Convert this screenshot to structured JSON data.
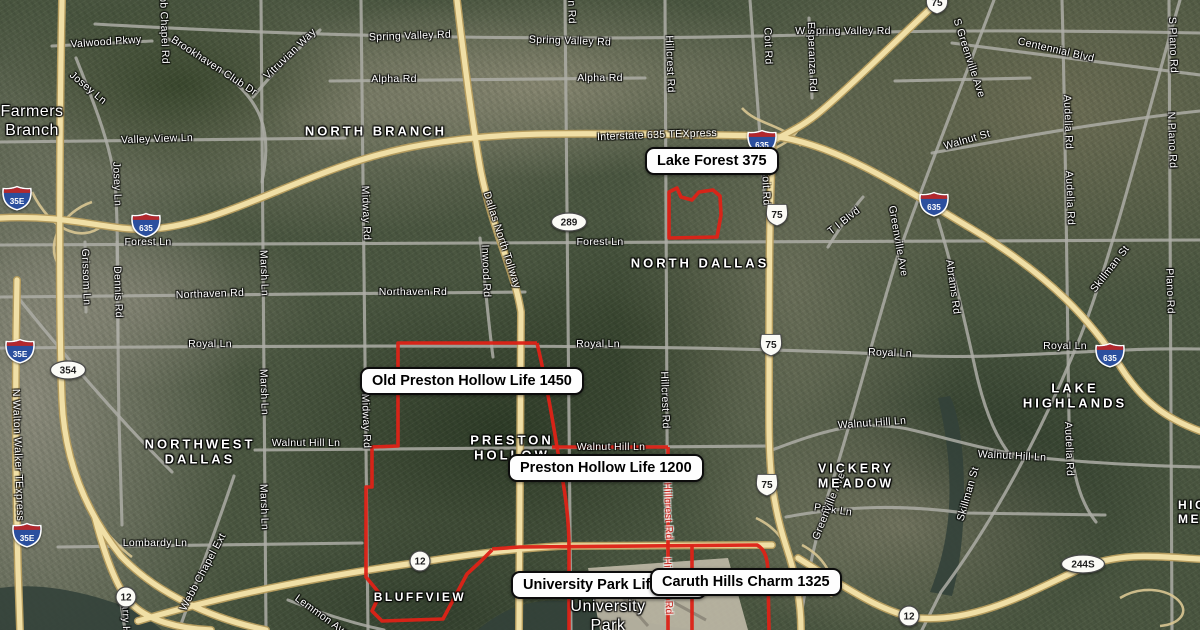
{
  "map": {
    "colors": {
      "boundary": "#dd2217",
      "highway_core": "#f0dfa6",
      "highway_casing": "#b59c5e",
      "road": "#adada6",
      "ramp": "#d9c792",
      "water": "#33413a",
      "airport": "#c7bfae",
      "marker_bg": "#fefefe",
      "marker_border": "#0c0c0c"
    },
    "markers": [
      {
        "id": "lake-forest",
        "label": "Lake Forest 375",
        "x": 645,
        "y": 147
      },
      {
        "id": "old-preston-hollow",
        "label": "Old Preston Hollow Life 1450",
        "x": 360,
        "y": 367
      },
      {
        "id": "preston-hollow",
        "label": "Preston Hollow Life 1200",
        "x": 508,
        "y": 454
      },
      {
        "id": "university-park",
        "label": "University Park Life 2300",
        "x": 511,
        "y": 571
      },
      {
        "id": "caruth-hills",
        "label": "Caruth Hills Charm 1325",
        "x": 650,
        "y": 568
      }
    ],
    "place_labels": [
      {
        "id": "farmers-branch",
        "text": "Farmers\nBranch",
        "x": 32,
        "y": 122,
        "size": 16,
        "spacing": 0.5,
        "weight": 400
      },
      {
        "id": "north-branch",
        "text": "NORTH BRANCH",
        "x": 376,
        "y": 131,
        "size": 13,
        "spacing": 3,
        "weight": 600
      },
      {
        "id": "north-dallas",
        "text": "NORTH DALLAS",
        "x": 700,
        "y": 263,
        "size": 13,
        "spacing": 3,
        "weight": 600
      },
      {
        "id": "northwest-dallas",
        "text": "NORTHWEST\nDALLAS",
        "x": 200,
        "y": 452,
        "size": 13,
        "spacing": 3,
        "weight": 600
      },
      {
        "id": "preston-hollow",
        "text": "PRESTON\nHOLLOW",
        "x": 512,
        "y": 448,
        "size": 13,
        "spacing": 3,
        "weight": 600
      },
      {
        "id": "vickery-meadow",
        "text": "VICKERY\nMEADOW",
        "x": 856,
        "y": 476,
        "size": 12.5,
        "spacing": 3,
        "weight": 600
      },
      {
        "id": "lake-highlands",
        "text": "LAKE\nHIGHLANDS",
        "x": 1075,
        "y": 396,
        "size": 13,
        "spacing": 3,
        "weight": 600
      },
      {
        "id": "bluffview",
        "text": "BLUFFVIEW",
        "x": 420,
        "y": 597,
        "size": 12,
        "spacing": 2.5,
        "weight": 600
      },
      {
        "id": "university-park",
        "text": "University\nPark",
        "x": 608,
        "y": 617,
        "size": 16,
        "spacing": 0.5,
        "weight": 400
      },
      {
        "id": "highland-meadows",
        "text": "HIGHLAND\nMEADOWS",
        "x": 1178,
        "y": 512,
        "size": 12,
        "spacing": 2.5,
        "weight": 600,
        "anchor": "left"
      }
    ],
    "road_labels": [
      {
        "text": "Valwood Pkwy",
        "x": 106,
        "y": 42,
        "rot": -4
      },
      {
        "text": "Josey Ln",
        "x": 88,
        "y": 88,
        "rot": 40
      },
      {
        "text": "Josey Ln",
        "x": 117,
        "y": 184,
        "rot": 88
      },
      {
        "text": "Brookhaven Club Dr",
        "x": 214,
        "y": 66,
        "rot": 33
      },
      {
        "text": "Vitruvian Way",
        "x": 290,
        "y": 54,
        "rot": -44
      },
      {
        "text": "Webb Chapel Rd",
        "x": 164,
        "y": 22,
        "rot": 88
      },
      {
        "text": "Spring Valley Rd",
        "x": 410,
        "y": 36,
        "rot": -2
      },
      {
        "text": "Spring Valley Rd",
        "x": 570,
        "y": 41,
        "rot": 2
      },
      {
        "text": "W Spring Valley Rd",
        "x": 843,
        "y": 31,
        "rot": 0
      },
      {
        "text": "Centennial Blvd",
        "x": 1056,
        "y": 50,
        "rot": 13
      },
      {
        "text": "Alpha Rd",
        "x": 394,
        "y": 79,
        "rot": 0
      },
      {
        "text": "Alpha Rd",
        "x": 600,
        "y": 78,
        "rot": 0
      },
      {
        "text": "Valley View Ln",
        "x": 157,
        "y": 139,
        "rot": -2
      },
      {
        "text": "Interstate 635 TEXpress",
        "x": 657,
        "y": 135,
        "rot": -2
      },
      {
        "text": "Forest Ln",
        "x": 148,
        "y": 242,
        "rot": 0
      },
      {
        "text": "Forest Ln",
        "x": 600,
        "y": 242,
        "rot": 0
      },
      {
        "text": "Northaven Rd",
        "x": 210,
        "y": 294,
        "rot": -2
      },
      {
        "text": "Northaven Rd",
        "x": 413,
        "y": 292,
        "rot": 0
      },
      {
        "text": "Royal Ln",
        "x": 210,
        "y": 344,
        "rot": 0
      },
      {
        "text": "Royal Ln",
        "x": 598,
        "y": 344,
        "rot": 0
      },
      {
        "text": "Royal Ln",
        "x": 890,
        "y": 353,
        "rot": 2
      },
      {
        "text": "Royal Ln",
        "x": 1065,
        "y": 346,
        "rot": 0
      },
      {
        "text": "Walnut Hill Ln",
        "x": 306,
        "y": 443,
        "rot": 0
      },
      {
        "text": "Walnut Hill Ln",
        "x": 611,
        "y": 447,
        "rot": 0
      },
      {
        "text": "Walnut Hill Ln",
        "x": 872,
        "y": 423,
        "rot": -4
      },
      {
        "text": "Walnut Hill Ln",
        "x": 1012,
        "y": 456,
        "rot": 3
      },
      {
        "text": "Lombardy Ln",
        "x": 155,
        "y": 543,
        "rot": 0
      },
      {
        "text": "Park Ln",
        "x": 833,
        "y": 510,
        "rot": 8
      },
      {
        "text": "Grissom Ln",
        "x": 86,
        "y": 277,
        "rot": 88
      },
      {
        "text": "Dennis Rd",
        "x": 118,
        "y": 292,
        "rot": 88
      },
      {
        "text": "Marsh Ln",
        "x": 264,
        "y": 273,
        "rot": 88
      },
      {
        "text": "Marsh Ln",
        "x": 264,
        "y": 392,
        "rot": 88
      },
      {
        "text": "Marsh Ln",
        "x": 264,
        "y": 507,
        "rot": 88
      },
      {
        "text": "Midway Rd",
        "x": 366,
        "y": 213,
        "rot": 88
      },
      {
        "text": "Midway Rd",
        "x": 366,
        "y": 421,
        "rot": 88
      },
      {
        "text": "Inwood Rd",
        "x": 486,
        "y": 271,
        "rot": 88
      },
      {
        "text": "Dallas North Tollway",
        "x": 502,
        "y": 240,
        "rot": 72
      },
      {
        "text": "Preston Rd",
        "x": 571,
        "y": -4,
        "rot": 88
      },
      {
        "text": "Hillcrest Rd",
        "x": 670,
        "y": 64,
        "rot": 88
      },
      {
        "text": "Hillcrest Rd",
        "x": 665,
        "y": 400,
        "rot": 88
      },
      {
        "text": "Hillcrest Rd",
        "x": 668,
        "y": 511,
        "rot": 88,
        "color": "red"
      },
      {
        "text": "Hillcrest Rd",
        "x": 668,
        "y": 586,
        "rot": 88,
        "color": "red"
      },
      {
        "text": "Coit Rd",
        "x": 768,
        "y": 46,
        "rot": 88
      },
      {
        "text": "Coit Rd",
        "x": 766,
        "y": 187,
        "rot": 88
      },
      {
        "text": "Esperanza Rd",
        "x": 812,
        "y": 57,
        "rot": 88
      },
      {
        "text": "T I Blvd",
        "x": 844,
        "y": 221,
        "rot": -38
      },
      {
        "text": "Greenville Ave",
        "x": 898,
        "y": 241,
        "rot": 80
      },
      {
        "text": "S Greenville Ave",
        "x": 969,
        "y": 58,
        "rot": 72
      },
      {
        "text": "Greenville Ave",
        "x": 829,
        "y": 506,
        "rot": -68
      },
      {
        "text": "Walnut St",
        "x": 967,
        "y": 140,
        "rot": -16
      },
      {
        "text": "Abrams Rd",
        "x": 953,
        "y": 287,
        "rot": 82
      },
      {
        "text": "Skillman St",
        "x": 1110,
        "y": 269,
        "rot": -52
      },
      {
        "text": "Skillman St",
        "x": 968,
        "y": 494,
        "rot": -74
      },
      {
        "text": "Audelia Rd",
        "x": 1068,
        "y": 122,
        "rot": 88
      },
      {
        "text": "Audelia Rd",
        "x": 1070,
        "y": 198,
        "rot": 88
      },
      {
        "text": "Audelia Rd",
        "x": 1069,
        "y": 449,
        "rot": 88
      },
      {
        "text": "S Plano Rd",
        "x": 1173,
        "y": 45,
        "rot": 88
      },
      {
        "text": "N Plano Rd",
        "x": 1172,
        "y": 140,
        "rot": 88
      },
      {
        "text": "Plano Rd",
        "x": 1170,
        "y": 291,
        "rot": 88
      },
      {
        "text": "N Walton Walker TExpress",
        "x": 18,
        "y": 455,
        "rot": 88
      },
      {
        "text": "Webb Chapel Ext",
        "x": 203,
        "y": 572,
        "rot": -62
      },
      {
        "text": "Lemmon Ave",
        "x": 322,
        "y": 616,
        "rot": 36
      },
      {
        "text": "Harry Hines",
        "x": 126,
        "y": 625,
        "rot": 88
      }
    ],
    "shields": [
      {
        "type": "interstate",
        "num": "635",
        "x": 146,
        "y": 225
      },
      {
        "type": "interstate",
        "num": "635",
        "x": 762,
        "y": 142
      },
      {
        "type": "interstate",
        "num": "635",
        "x": 934,
        "y": 204
      },
      {
        "type": "interstate",
        "num": "635",
        "x": 1110,
        "y": 355
      },
      {
        "type": "interstate",
        "num": "35E",
        "x": 17,
        "y": 198
      },
      {
        "type": "interstate",
        "num": "35E",
        "x": 20,
        "y": 351
      },
      {
        "type": "interstate",
        "num": "35E",
        "x": 27,
        "y": 535
      },
      {
        "type": "us",
        "num": "75",
        "x": 777,
        "y": 215
      },
      {
        "type": "us",
        "num": "75",
        "x": 771,
        "y": 345
      },
      {
        "type": "us",
        "num": "75",
        "x": 767,
        "y": 485
      },
      {
        "type": "us",
        "num": "75",
        "x": 937,
        "y": 3
      },
      {
        "type": "tx",
        "num": "289",
        "x": 569,
        "y": 222
      },
      {
        "type": "tx",
        "num": "354",
        "x": 68,
        "y": 370
      },
      {
        "type": "tx",
        "num": "244S",
        "x": 1083,
        "y": 564
      },
      {
        "type": "loop",
        "num": "12",
        "x": 126,
        "y": 597
      },
      {
        "type": "loop",
        "num": "12",
        "x": 420,
        "y": 561
      },
      {
        "type": "loop",
        "num": "12",
        "x": 909,
        "y": 616
      }
    ],
    "boundaries": [
      {
        "name": "lake-forest-outline",
        "d": "M669,192 L677,188 L681,197 L692,200 L699,192 L713,190 L720,196 L721,215 L717,237 L669,238 Z"
      },
      {
        "name": "old-preston-hollow-outline",
        "d": "M537,343 L398,343 L398,446 L372,447 L372,487 L366,487 L366,577 L380,594 L372,611 L382,621 L443,619 L451,604 L467,574 L481,561 L492,550"
      },
      {
        "name": "old-preston-hollow-east-edge",
        "d": "M537,343 C544,372 551,410 557,447 C563,481 569,512 569,547 L569,630"
      },
      {
        "name": "northwest-hwy-boundary",
        "d": "M492,549 L520,547 L757,545 C765,549 768,559 768,574 L769,630"
      },
      {
        "name": "walnut-hill-boundary",
        "d": "M552,447 L668,447"
      },
      {
        "name": "hillcrest-boundary",
        "d": "M668,447 L668,630"
      },
      {
        "name": "caruth-west-boundary",
        "d": "M692,545 L692,630"
      }
    ],
    "roads": {
      "highways": [
        "M0,218 C70,214 112,232 152,229 C232,223 312,164 422,145 C502,131 562,134 652,134 L772,136",
        "M772,136 C832,143 892,181 972,229 C1052,277 1092,322 1120,366 C1144,404 1168,419 1200,431",
        "M940,0 C906,30 856,82 821,111 C801,128 786,133 773,141",
        "M773,141 C769,200 769,300 769,420 C769,472 773,506 786,546 C796,576 801,602 801,630",
        "M62,0 C60,100 58,300 62,400 C64,452 81,506 121,556 C156,593 212,619 266,630",
        "M17,280 C15,380 15,500 20,630",
        "M138,621 C222,596 322,576 422,562 C472,554 522,548 562,546 L772,545",
        "M798,558 C840,584 882,613 917,618 C977,623 1032,591 1082,568 C1122,551 1162,557 1200,559",
        "M457,0 C464,60 472,122 481,172 C493,232 515,272 521,312 L519,630",
        "M95,518 C105,556 116,586 129,601 C146,621 181,629 211,630"
      ],
      "ramps": [
        "M742,108 C758,126 786,124 801,146",
        "M746,168 C762,146 790,152 802,122",
        "M32,192 C52,232 82,242 102,226",
        "M92,202 C62,212 47,242 57,262",
        "M756,518 C782,530 796,556 791,578",
        "M802,545 C823,556 837,577 831,597",
        "M1120,598 C1140,586 1165,588 1178,600 C1190,612 1180,624 1160,626",
        "M82,498 C96,520 112,542 132,557"
      ],
      "arterials": [
        "M95,24 C300,36 600,44 885,32 C985,30 1100,31 1200,33",
        "M330,81 L645,78",
        "M895,81 L1030,78",
        "M0,142 L345,138",
        "M52,46 L152,41",
        "M0,245 L1200,240",
        "M0,297 L525,292",
        "M0,348 C400,345 700,344 900,355 C1000,361 1100,347 1200,349",
        "M255,450 L772,446",
        "M772,450 C830,428 862,420 908,429 C955,440 995,453 1042,458 C1100,464 1160,466 1200,467",
        "M58,547 L362,543",
        "M786,517 C850,505 905,505 965,513 L1105,515",
        "M952,43 C1030,53 1110,63 1200,75",
        "M932,153 C1010,139 1105,121 1200,111",
        "M76,58 C92,98 110,142 115,182 C119,230 117,320 119,420 C120,460 121,500 122,525",
        "M261,0 L266,630",
        "M361,0 L368,630",
        "M480,238 C485,280 488,320 493,357",
        "M565,0 L571,630",
        "M665,0 L668,630",
        "M750,0 C755,70 760,140 765,205",
        "M994,0 C962,85 926,175 898,255 C876,325 851,425 829,492 C816,535 806,580 799,630",
        "M1180,0 C1152,95 1116,245 1081,335 C1041,435 991,525 941,592 L922,630",
        "M938,220 C951,262 963,312 976,372 C986,417 999,442 1012,457",
        "M1062,0 C1066,150 1067,300 1069,420 C1071,472 1080,502 1096,522",
        "M1169,0 L1172,630",
        "M828,247 C839,229 851,211 863,197",
        "M809,18 L812,98",
        "M166,38 C210,60 251,86 262,122 C268,142 266,162 262,182",
        "M253,97 C274,71 296,50 320,30",
        "M234,476 C216,530 196,582 179,630",
        "M117,242 L118,342",
        "M85,242 L86,312",
        "M288,600 C320,613 352,623 384,630",
        "M120,598 L125,630",
        "M20,300 C62,352 112,412 172,472"
      ]
    },
    "water": [
      "M0,588 C40,582 82,592 112,602 C134,609 152,621 162,630 L0,630 Z",
      "M478,630 C510,602 548,594 590,606 C632,620 660,627 700,630 Z",
      "M938,398 C948,440 952,480 948,520 C945,548 938,572 930,592 L952,596 C962,560 966,510 963,460 C961,430 956,408 950,396 Z"
    ],
    "airport": {
      "pad": "M588,568 L728,558 L748,630 L600,630 Z",
      "runways": [
        "M604,576 L648,626",
        "M618,572 L706,620"
      ]
    }
  }
}
